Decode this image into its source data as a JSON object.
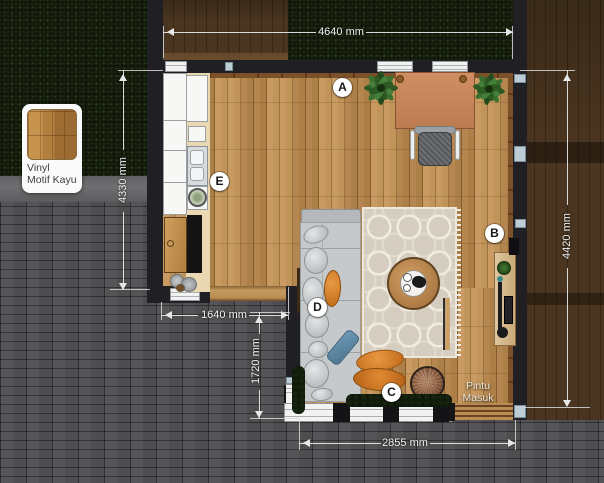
{
  "plan_title": "Floor plan - living room and kitchen",
  "legend": {
    "line1": "Vinyl",
    "line2": "Motif Kayu"
  },
  "entrance": {
    "line1": "Pintu",
    "line2": "Masuk"
  },
  "dimensions": {
    "top": "4640 mm",
    "left": "4330 mm",
    "kitchen_width": "1640 mm",
    "lower_left": "1720 mm",
    "bottom": "2855 mm",
    "right": "4420 mm"
  },
  "markers": [
    {
      "letter": "A"
    },
    {
      "letter": "B"
    },
    {
      "letter": "C"
    },
    {
      "letter": "D"
    },
    {
      "letter": "E"
    }
  ],
  "colors": {
    "grass": "#18220f",
    "brick": "#454547",
    "deck_wood": "#46321d",
    "room_floor": "#b9884e",
    "wall": "#202024",
    "desk": "#c7855b",
    "sofa": "#c6c9cb",
    "rug": "#d6cfc1",
    "dimension_text": "#f2f2f2",
    "marker_bg": "#ffffff"
  }
}
